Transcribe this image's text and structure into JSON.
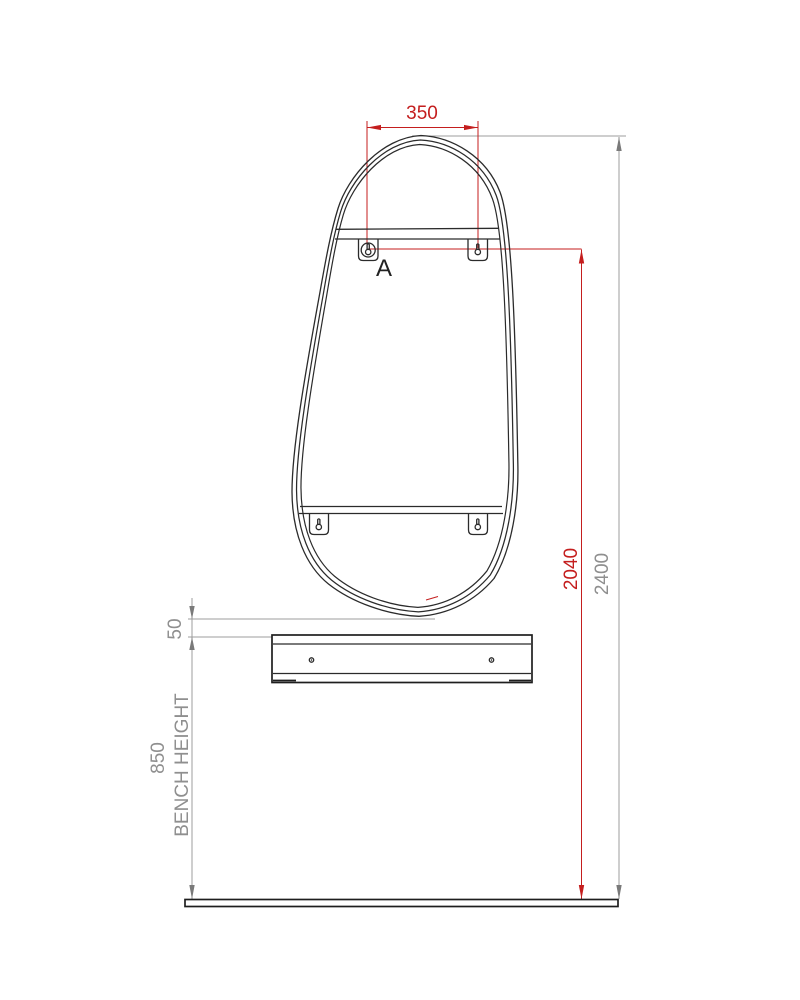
{
  "drawing": {
    "dim_fixing_width": "350",
    "dim_fixing_height": "2040",
    "dim_overall_height": "2400",
    "dim_shelf_gap": "50",
    "dim_bench_height": "850",
    "bench_height_label": "BENCH HEIGHT",
    "detail_label": "A"
  },
  "colors": {
    "dimension_red": "#c41e1e",
    "dimension_gray": "#9c9c9c",
    "text_gray": "#8f8f8f",
    "drawing_black": "#2b2b2b",
    "background": "#ffffff"
  },
  "icons": {
    "keyhole_bracket": "keyhole-mount-icon",
    "screw_hole": "screw-hole-icon"
  }
}
